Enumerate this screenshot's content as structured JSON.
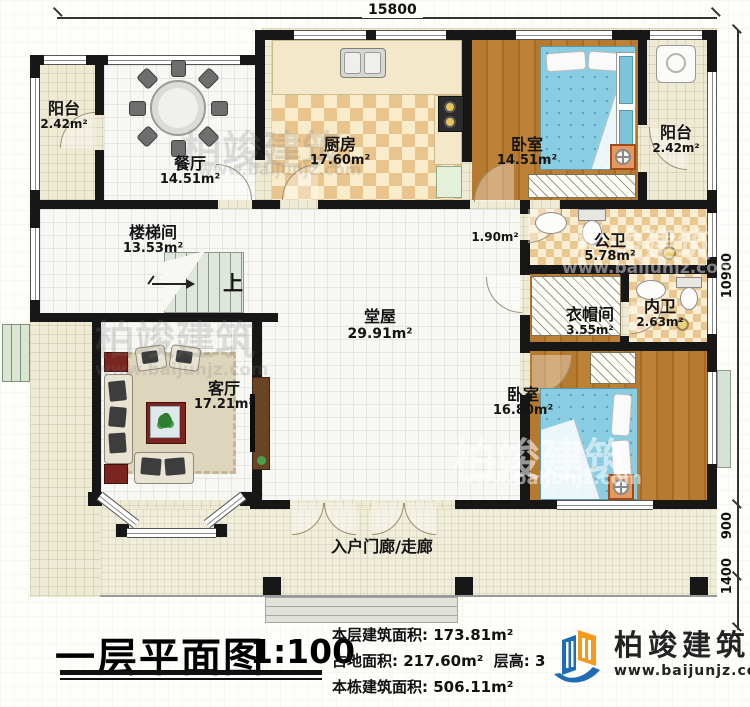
{
  "dimensions": {
    "top": "15800",
    "right_main": "10900",
    "right_porch": "900",
    "right_steps": "1400"
  },
  "rooms": [
    {
      "name": "阳台",
      "area": "2.42m²"
    },
    {
      "name": "餐厅",
      "area": "14.51m²"
    },
    {
      "name": "厨房",
      "area": "17.60m²"
    },
    {
      "name": "卧室",
      "area": "14.51m²"
    },
    {
      "name": "阳台",
      "area": "2.42m²"
    },
    {
      "name": "楼梯间",
      "area": "13.53m²"
    },
    {
      "name": "",
      "area": "1.90m²"
    },
    {
      "name": "公卫",
      "area": "5.78m²"
    },
    {
      "name": "衣帽间",
      "area": "3.55m²"
    },
    {
      "name": "内卫",
      "area": "2.63m²"
    },
    {
      "name": "堂屋",
      "area": "29.91m²"
    },
    {
      "name": "客厅",
      "area": "17.21m²"
    },
    {
      "name": "卧室",
      "area": "16.80m²"
    },
    {
      "name": "入户门廊/走廊",
      "area": ""
    }
  ],
  "stairs": {
    "up_label": "上"
  },
  "watermark": {
    "text": "柏竣建筑",
    "url": "www.baijunjz.com"
  },
  "footer": {
    "title": "一层平面图",
    "scale": "1:100",
    "floor_area_label": "本层建筑面积:",
    "floor_area_value": "173.81m²",
    "site_area_label": "占地面积:",
    "site_area_value": "217.60m²",
    "height_label": "层高:",
    "height_value": "3",
    "total_area_label": "本栋建筑面积:",
    "total_area_value": "506.11m²"
  },
  "brand": {
    "name": "柏竣建筑",
    "url": "www.baijunjz.com"
  }
}
